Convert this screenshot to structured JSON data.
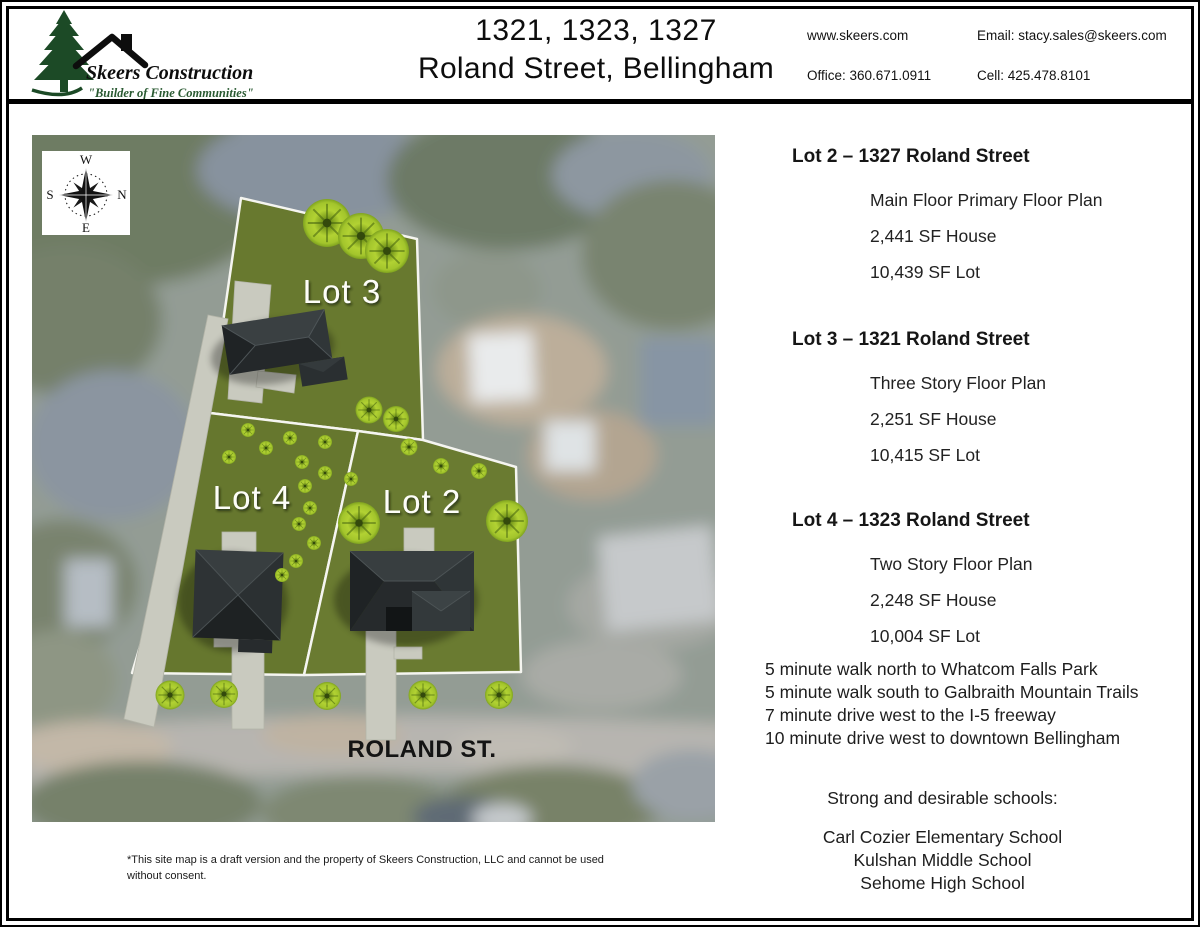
{
  "header": {
    "logo": {
      "company": "Skeers Construction",
      "tagline": "\"Builder of Fine Communities\""
    },
    "title": {
      "line1": "1321, 1323, 1327",
      "line2": "Roland Street, Bellingham"
    },
    "contact": {
      "website": "www.skeers.com",
      "office": "Office: 360.671.0911",
      "email": "Email: stacy.sales@skeers.com",
      "cell": "Cell: 425.478.8101"
    }
  },
  "map": {
    "compass": {
      "top": "W",
      "right": "N",
      "bottom": "E",
      "left": "S"
    },
    "lots": {
      "lot3": "Lot 3",
      "lot4": "Lot 4",
      "lot2": "Lot 2"
    },
    "street": "ROLAND ST.",
    "colors": {
      "lot_green": "#68792f",
      "driveway": "#c9cabf",
      "house_roof": "#2b3032",
      "tree": "#aecb31"
    }
  },
  "listings": [
    {
      "heading": "Lot 2 – 1327 Roland Street",
      "lines": [
        "Main Floor Primary Floor Plan",
        "2,441 SF House",
        "10,439 SF Lot"
      ]
    },
    {
      "heading": "Lot 3 – 1321 Roland Street",
      "lines": [
        "Three Story Floor Plan",
        "2,251 SF House",
        "10,415 SF Lot"
      ]
    },
    {
      "heading": "Lot 4 – 1323 Roland Street",
      "lines": [
        "Two Story Floor Plan",
        "2,248 SF House",
        "10,004 SF Lot"
      ]
    }
  ],
  "location_notes": [
    "5 minute walk north to Whatcom Falls Park",
    "5 minute walk south to Galbraith Mountain Trails",
    "7 minute drive west to the I-5 freeway",
    "10 minute drive west to downtown Bellingham"
  ],
  "schools": {
    "heading": "Strong and desirable schools:",
    "items": [
      "Carl Cozier Elementary School",
      "Kulshan Middle School",
      "Sehome High School"
    ]
  },
  "disclaimer": {
    "line1": "*This site map is a draft version and the property of Skeers Construction, LLC and cannot be used",
    "line2": "without consent."
  }
}
